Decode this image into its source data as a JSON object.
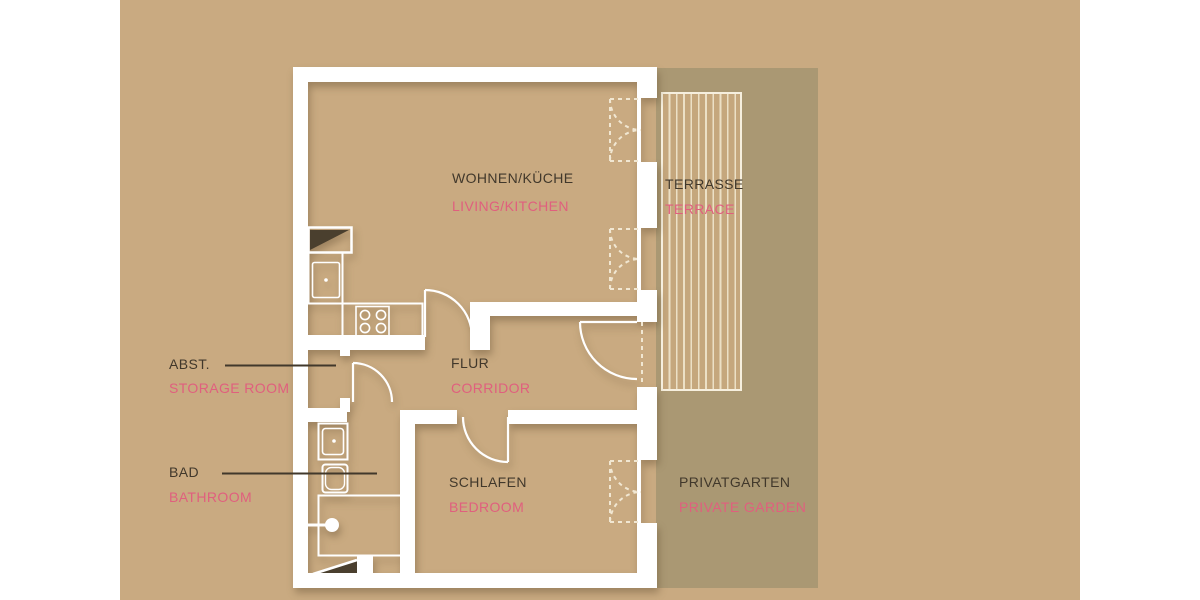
{
  "canvas": {
    "background_color": "#ffffff",
    "plot_bg_color": "#c9aa81",
    "garden_overlay_color": "#aa9873",
    "wall_color": "#ffffff",
    "label_color_german": "#41382b",
    "label_color_english": "#e05f7e",
    "terrace_stripe_color": "#ece0c6",
    "terrace_fill_color": "#c5a77d"
  },
  "rooms": [
    {
      "id": "living-kitchen",
      "de": "WOHNEN/KÜCHE",
      "en": "LIVING/KITCHEN"
    },
    {
      "id": "terrace",
      "de": "TERRASSE",
      "en": "TERRACE"
    },
    {
      "id": "storage",
      "de": "ABST.",
      "en": "STORAGE ROOM"
    },
    {
      "id": "corridor",
      "de": "FLUR",
      "en": "CORRIDOR"
    },
    {
      "id": "bathroom",
      "de": "BAD",
      "en": "BATHROOM"
    },
    {
      "id": "bedroom",
      "de": "SCHLAFEN",
      "en": "BEDROOM"
    },
    {
      "id": "private-garden",
      "de": "PRIVATGARTEN",
      "en": "PRIVATE GARDEN"
    }
  ],
  "icons": [
    "shaft-icon",
    "kitchen-sink-icon",
    "stove-icon",
    "washbasin-icon",
    "toilet-icon",
    "shower-icon",
    "door-swing-icon",
    "casement-window-icon"
  ]
}
